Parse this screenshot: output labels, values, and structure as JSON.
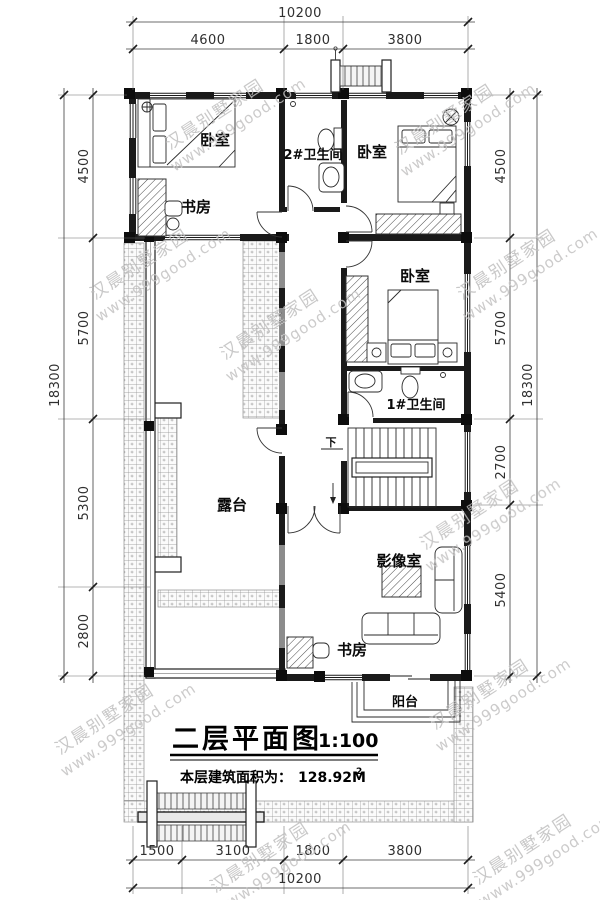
{
  "drawing": {
    "title": "二层平面图",
    "scale": "1:100",
    "area_label": "本层建筑面积为：",
    "area_value": "128.92M",
    "area_superscript": "2"
  },
  "watermark": {
    "line1": "汉晨别墅家园",
    "line2": "www.999good.com"
  },
  "dimensions": {
    "top": {
      "total": "10200",
      "segments": [
        "4600",
        "1800",
        "3800"
      ]
    },
    "bottom": {
      "total": "10200",
      "segments": [
        "1500",
        "3100",
        "1800",
        "3800"
      ]
    },
    "left": {
      "total": "18300",
      "segments": [
        "4500",
        "5700",
        "5300",
        "2800"
      ]
    },
    "right": {
      "total": "18300",
      "segments": [
        "4500",
        "5700",
        "2700",
        "5400"
      ]
    }
  },
  "rooms": {
    "bedroom_nw": "卧室",
    "study_nw": "书房",
    "bathroom2": "2#卫生间",
    "bedroom_ne": "卧室",
    "bedroom_e": "卧室",
    "bathroom1": "1#卫生间",
    "terrace": "露台",
    "media_room": "影像室",
    "study_s": "书房",
    "balcony": "阳台",
    "stair_down": "下"
  }
}
